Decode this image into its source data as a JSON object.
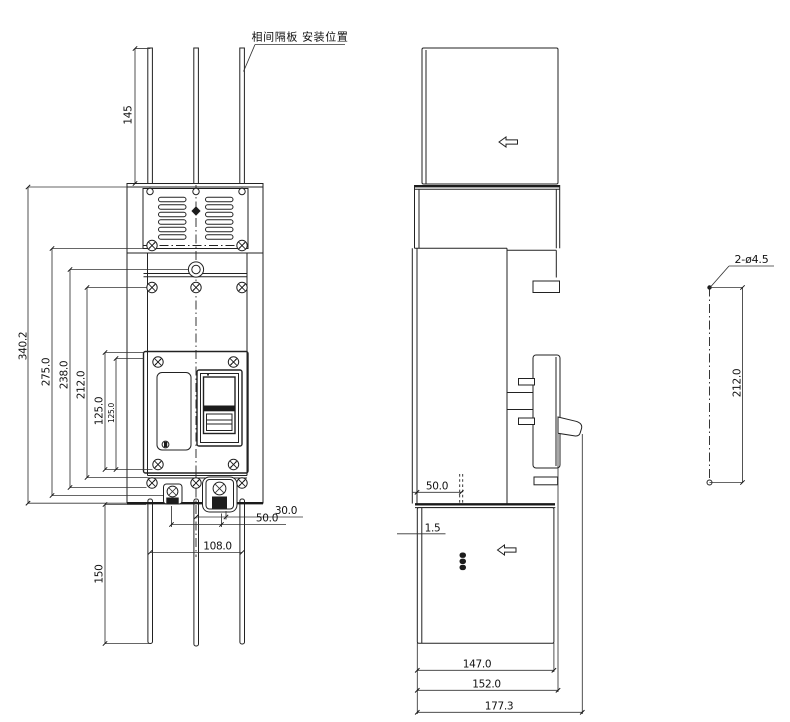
{
  "drawing": {
    "background": "#ffffff",
    "line_color": "#222222",
    "note": {
      "phase_barrier_position": "相间隔板 安装位置"
    },
    "front_view": {
      "dim_separator_top_length": "145",
      "dim_overall_height": "340.2",
      "dim_height_275": "275.0",
      "dim_height_238": "238.0",
      "dim_height_212": "212.0",
      "dim_height_125_outer": "125.0",
      "dim_height_125_inner": "125.0",
      "dim_separator_bottom_length": "150",
      "dim_offset_30": "30.0",
      "dim_offset_50": "50.0",
      "dim_pitch_108": "108.0"
    },
    "side_view": {
      "dim_barrier_depth_50": "50.0",
      "dim_gap_1_5": "1.5",
      "dim_depth_147": "147.0",
      "dim_depth_152": "152.0",
      "dim_depth_177": "177.3"
    },
    "hole_detail": {
      "hole_callout": "2-ø4.5",
      "dim_hole_spacing_212": "212.0"
    },
    "icons": {
      "direction_arrow_upper": "left-arrow",
      "direction_arrow_lower": "left-arrow"
    }
  }
}
